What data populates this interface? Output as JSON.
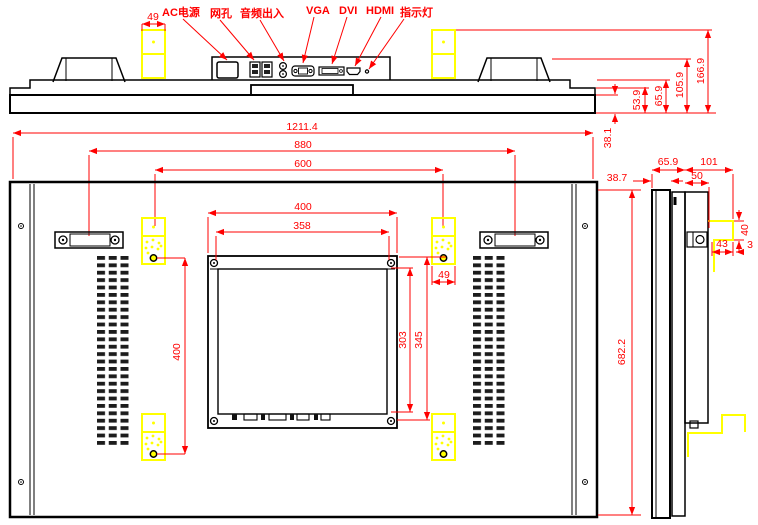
{
  "colors": {
    "dimension_red": "#FF0000",
    "bracket_yellow": "#FFFF00",
    "line_black": "#000000",
    "background": "#FFFFFF"
  },
  "top_view": {
    "port_labels": {
      "ac": "AC电源",
      "lan": "网孔",
      "audio": "音频出入",
      "vga": "VGA",
      "dvi": "DVI",
      "hdmi": "HDMI",
      "led": "指示灯"
    },
    "dims": {
      "bracket_width": "49",
      "bezel_depth": "38.1",
      "step_depth": "53.9",
      "body_depth": "65.9",
      "handle_depth": "105.9",
      "bracket_depth": "166.9"
    }
  },
  "front_dims": {
    "overall_width": "1211.4",
    "handle_spacing": "880",
    "bracket_spacing": "600"
  },
  "back_view": {
    "dims": {
      "vesa_outer_width": "400",
      "vesa_inner_width": "358",
      "vesa_inner_height": "303",
      "vesa_outer_height": "345",
      "bracket_hole_pitch": "400",
      "bracket_width": "49",
      "overall_height": "682.2"
    }
  },
  "side_view": {
    "dims": {
      "panel_depth": "65.9",
      "mount_depth": "101",
      "lcd_depth": "38.7",
      "module_depth": "50",
      "hook_height": "40",
      "hook_depth": "43",
      "hook_gap": "3"
    }
  }
}
